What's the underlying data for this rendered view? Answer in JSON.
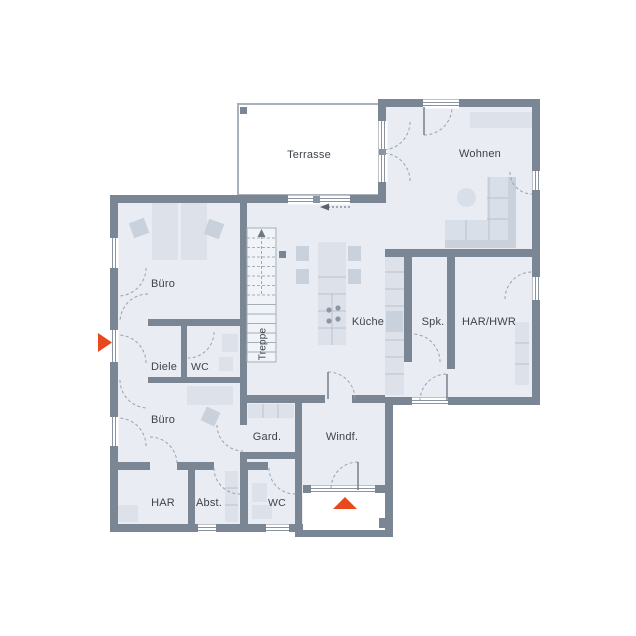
{
  "plan": {
    "type": "floor-plan",
    "rooms": [
      {
        "id": "terrasse",
        "label": "Terrasse"
      },
      {
        "id": "wohnen",
        "label": "Wohnen"
      },
      {
        "id": "buero-1",
        "label": "Büro"
      },
      {
        "id": "diele",
        "label": "Diele"
      },
      {
        "id": "wc-1",
        "label": "WC"
      },
      {
        "id": "buero-2",
        "label": "Büro"
      },
      {
        "id": "kueche",
        "label": "Küche"
      },
      {
        "id": "spk",
        "label": "Spk."
      },
      {
        "id": "har-hwr",
        "label": "HAR/HWR"
      },
      {
        "id": "gard",
        "label": "Gard."
      },
      {
        "id": "windf",
        "label": "Windf."
      },
      {
        "id": "har",
        "label": "HAR"
      },
      {
        "id": "abst",
        "label": "Abst."
      },
      {
        "id": "wc-2",
        "label": "WC"
      },
      {
        "id": "treppe",
        "label": "Treppe"
      }
    ],
    "markers": [
      {
        "id": "entrance-arrow-west",
        "shape": "triangle-right",
        "color": "#e8481c"
      },
      {
        "id": "entrance-arrow-south",
        "shape": "triangle-up",
        "color": "#e8481c"
      }
    ],
    "colors": {
      "wall": "#7b8694",
      "floor": "#e9edf3",
      "furniture": "#dde2ea",
      "furniture_dark": "#c9d1dc",
      "stair_line": "#a6aeba",
      "accent": "#e8481c",
      "text": "#3d434d"
    }
  }
}
